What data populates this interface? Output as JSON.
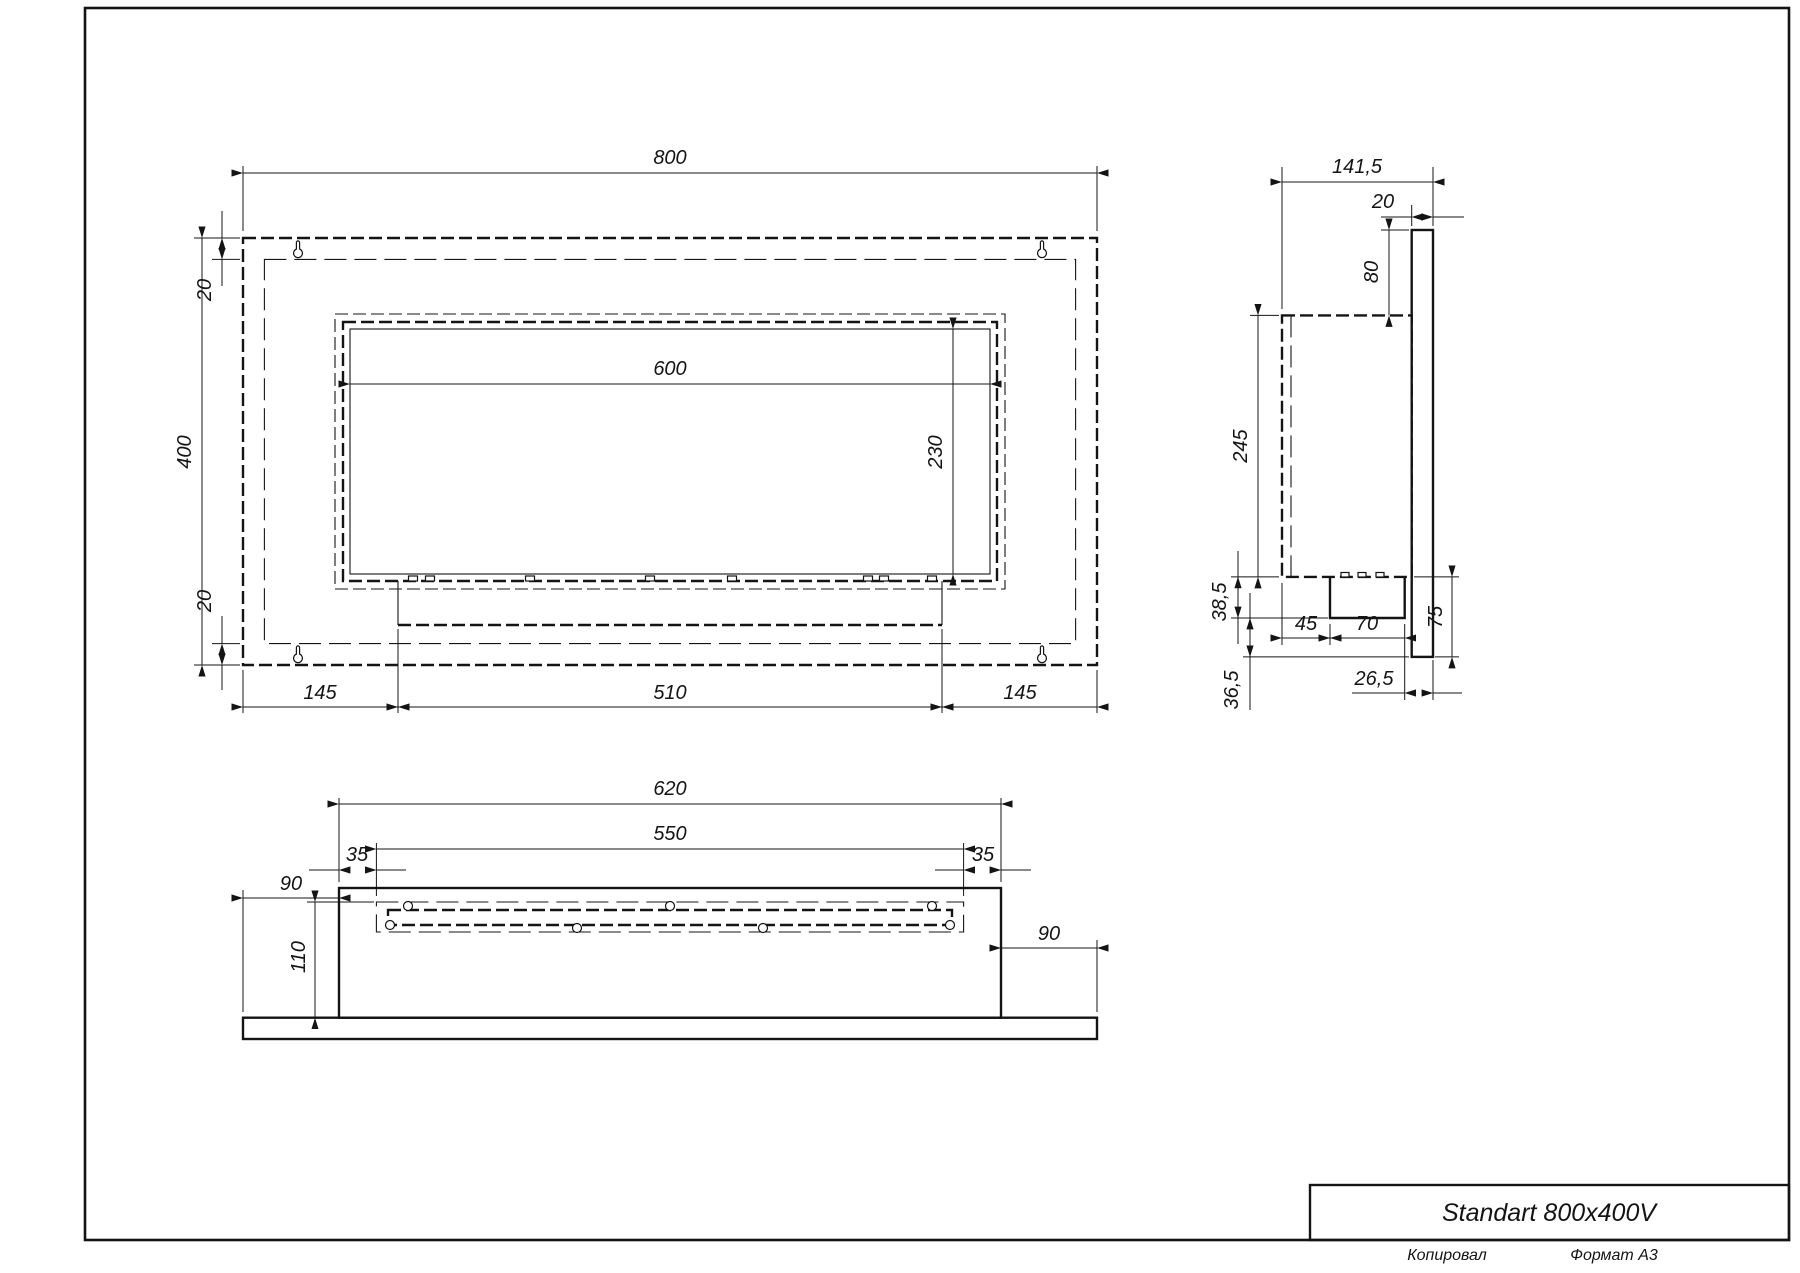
{
  "title_block": {
    "name": "Standart 800x400V"
  },
  "page": {
    "copied_label": "Копировал",
    "format_label": "Формат A3"
  },
  "front_view": {
    "dims": {
      "width": "800",
      "height": "400",
      "margin_top": "20",
      "margin_bottom": "20",
      "opening_width": "600",
      "opening_height": "230",
      "offset_left": "145",
      "tray_width": "510",
      "offset_right": "145"
    }
  },
  "side_view": {
    "dims": {
      "depth": "141,5",
      "plate_thickness": "20",
      "top_drop": "80",
      "body_height": "245",
      "base_height": "38,5",
      "box_offset": "45",
      "box_width": "70",
      "plate_lower": "75",
      "bottom_gap": "36,5",
      "rear_gap": "26,5"
    }
  },
  "bottom_view": {
    "dims": {
      "width": "620",
      "inner_width": "550",
      "inset_left": "35",
      "inset_right": "35",
      "overhang_left": "90",
      "overhang_right": "90",
      "inner_depth": "110"
    }
  }
}
